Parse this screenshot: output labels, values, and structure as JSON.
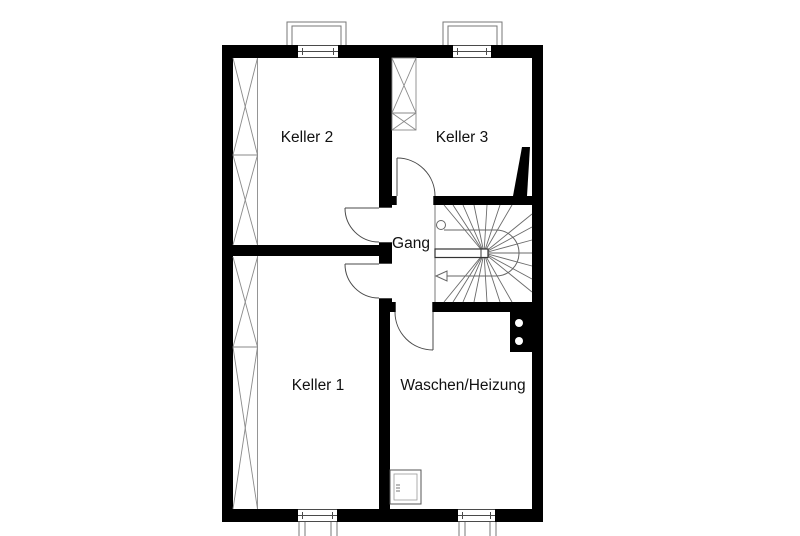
{
  "plan_type": "basement floor plan",
  "rooms": [
    {
      "id": "keller2",
      "label": "Keller 2"
    },
    {
      "id": "keller3",
      "label": "Keller 3"
    },
    {
      "id": "gang",
      "label": "Gang"
    },
    {
      "id": "keller1",
      "label": "Keller 1"
    },
    {
      "id": "waschen",
      "label": "Waschen/Heizung"
    }
  ],
  "colors": {
    "walls": "#000000",
    "background": "#ffffff",
    "thin_lines": "#4a4a4a",
    "hatch_lines": "#8a8a8a",
    "stair_lines": "#666666",
    "text": "#111111"
  },
  "symbols": [
    {
      "name": "stair-walk-line",
      "description": "winder stair with start circle and left direction arrow"
    },
    {
      "name": "chimney-block",
      "flue_count": 2
    },
    {
      "name": "light-wells",
      "count": 4
    }
  ]
}
